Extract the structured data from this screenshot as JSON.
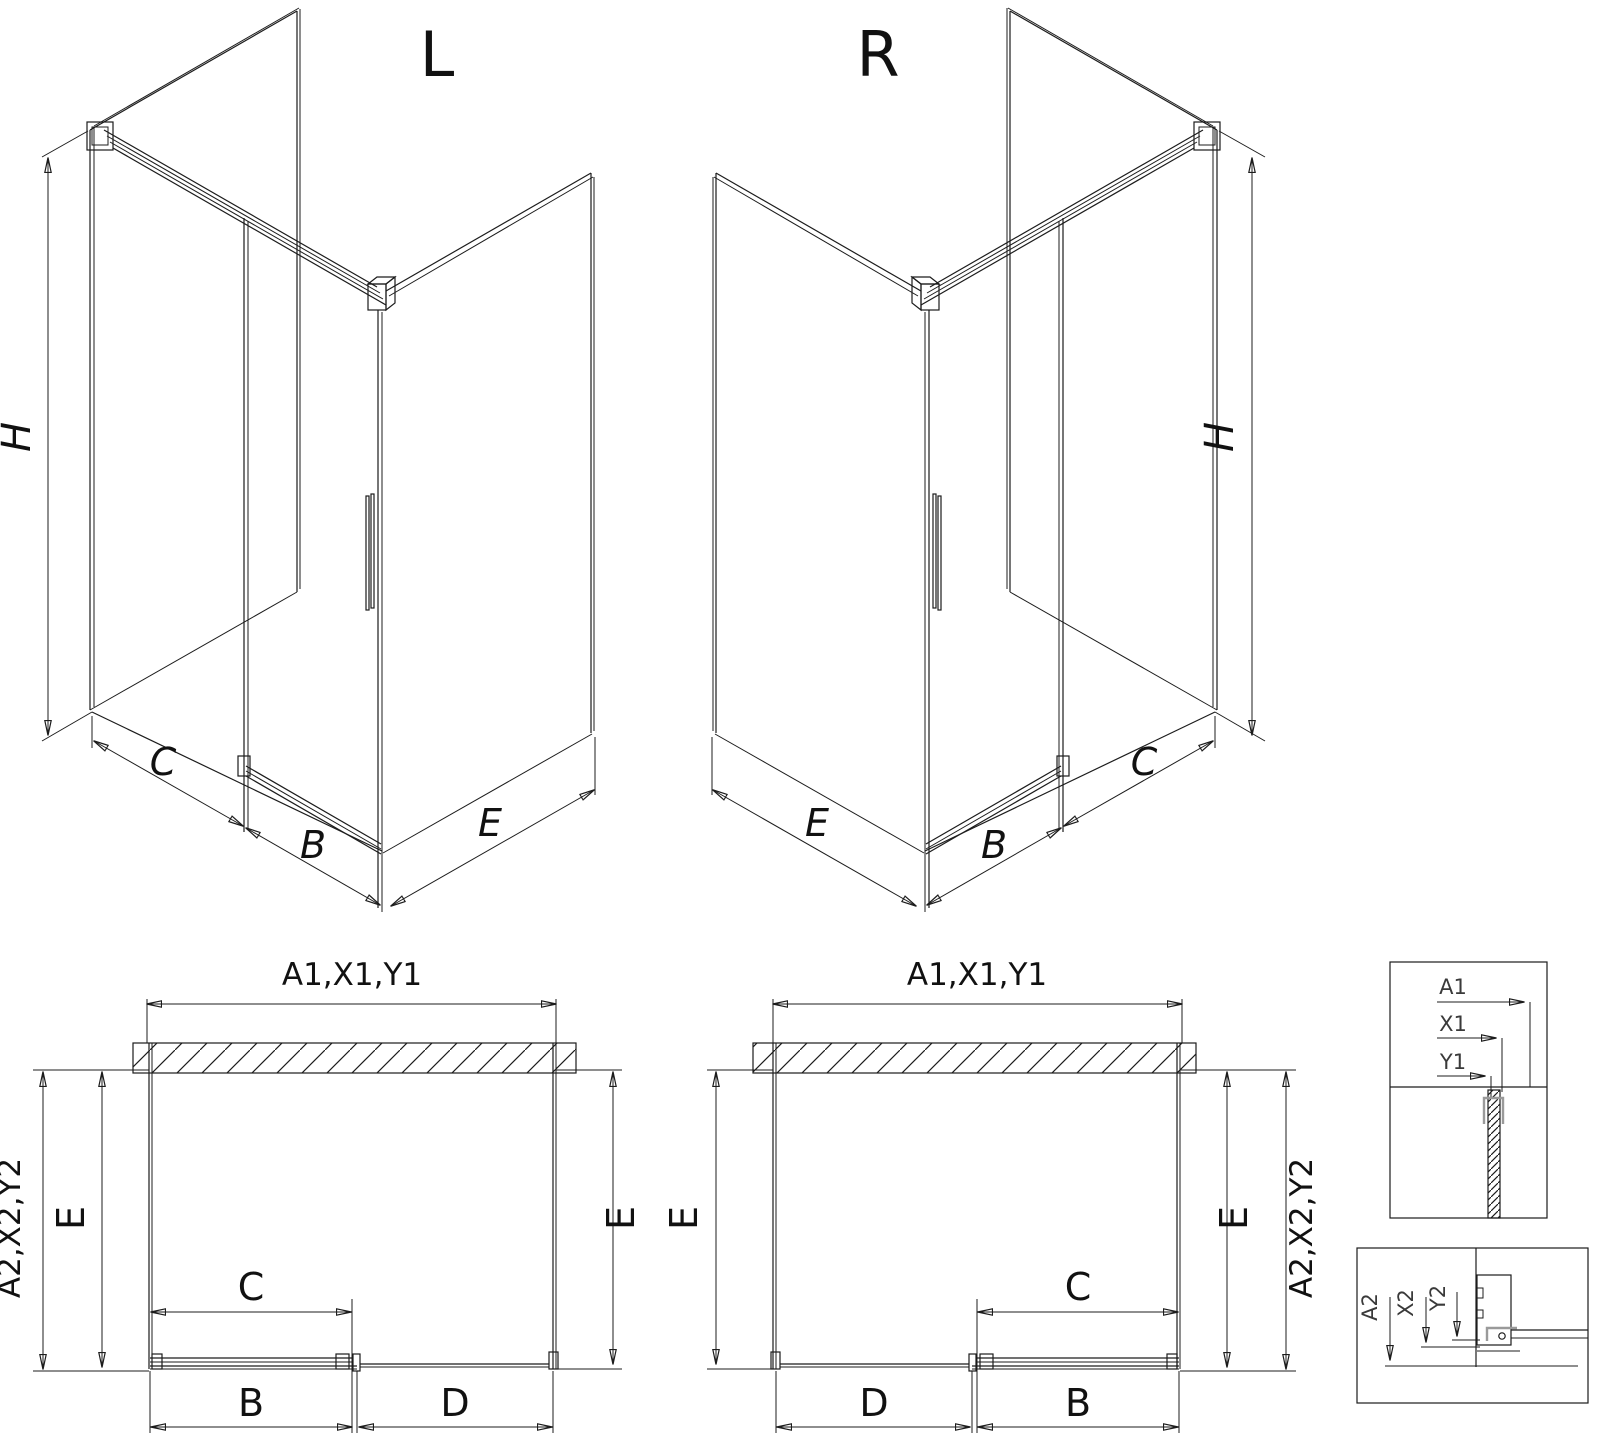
{
  "iso_left": {
    "title": "L",
    "h": "H",
    "c": "C",
    "b": "B",
    "e": "E"
  },
  "iso_right": {
    "title": "R",
    "h": "H",
    "c": "C",
    "b": "B",
    "e": "E"
  },
  "plan_left": {
    "a1": "A1,X1,Y1",
    "a2": "A2,X2,Y2",
    "e_left": "E",
    "e_right": "E",
    "c": "C",
    "b": "B",
    "d": "D"
  },
  "plan_right": {
    "a1": "A1,X1,Y1",
    "a2": "A2,X2,Y2",
    "e_left": "E",
    "e_right": "E",
    "c": "C",
    "b": "B",
    "d": "D"
  },
  "detail_top": {
    "a1": "A1",
    "x1": "X1",
    "y1": "Y1"
  },
  "detail_bottom": {
    "a2": "A2",
    "x2": "X2",
    "y2": "Y2"
  },
  "colors": {
    "line": "#1c1c1c",
    "profile_gray": "#9a9a9a",
    "background": "#ffffff"
  }
}
